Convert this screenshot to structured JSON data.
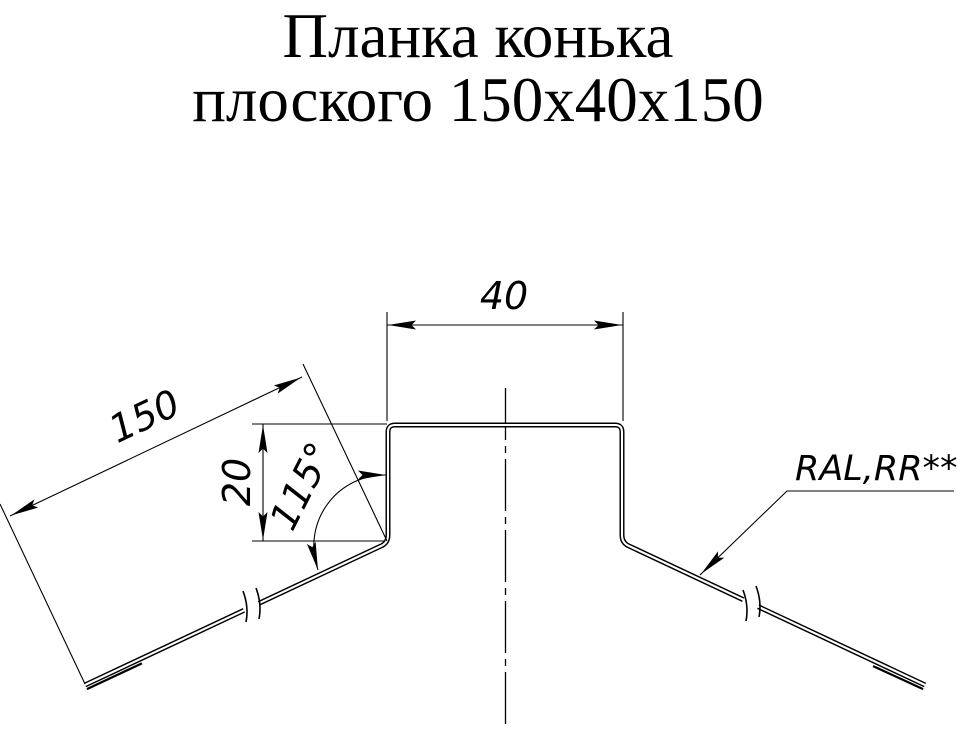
{
  "title": {
    "line1": "Планка конька",
    "line2": "плоского 150х40х150"
  },
  "dimensions": {
    "top_width": {
      "value": "40"
    },
    "flange_length": {
      "value": "150"
    },
    "leg_height": {
      "value": "20"
    },
    "bend_angle": {
      "value": "115°"
    }
  },
  "leader": {
    "label": "RAL,RR**"
  },
  "colors": {
    "line": "#000000",
    "background": "#ffffff"
  }
}
